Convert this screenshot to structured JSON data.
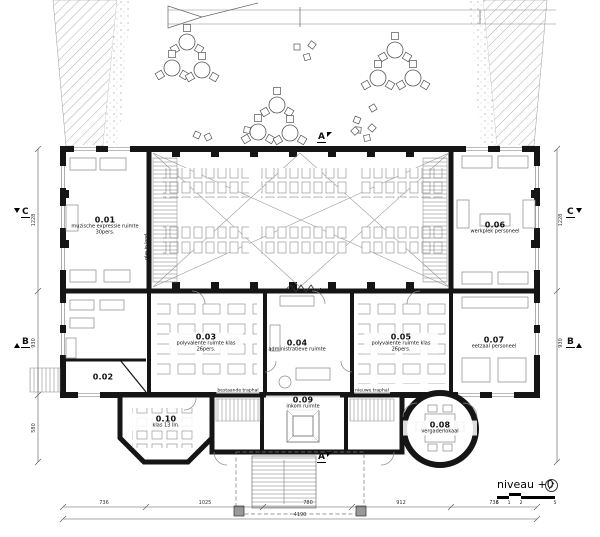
{
  "drawing": {
    "title": "niveau +0",
    "scale_ticks": [
      "0",
      "1",
      "2",
      "5"
    ]
  },
  "icons": {
    "north": "north-arrow-circle",
    "section_cut": "filled-triangle-flag"
  },
  "rooms": [
    {
      "number": "0.01",
      "label": "muzische expressie ruimte 30pers."
    },
    {
      "number": "0.02",
      "label": ""
    },
    {
      "number": "0.03",
      "label": "polyvalente ruimte klas 26pers."
    },
    {
      "number": "0.04",
      "label": "administratieve ruimte"
    },
    {
      "number": "0.05",
      "label": "polyvalente ruimte klas 26pers."
    },
    {
      "number": "0.06",
      "label": "werkplek personeel"
    },
    {
      "number": "0.07",
      "label": "eetzaal personeel"
    },
    {
      "number": "0.08",
      "label": "vergaderlokaal"
    },
    {
      "number": "0.09",
      "label": "inkom ruimte"
    },
    {
      "number": "0.10",
      "label": "klas 13 lln."
    }
  ],
  "annotations": {
    "glas_in_lood": "glas in lood",
    "stair_left": "bestaande traphal",
    "stair_right": "nieuwe traphal"
  },
  "section_markers": {
    "a": "A",
    "b": "B",
    "c": "C"
  },
  "dimensions": {
    "bottom_total": "4190",
    "bottom_segments": [
      "736",
      "1025",
      "780",
      "912",
      "736"
    ],
    "left_segments": [
      "1228",
      "930",
      "580"
    ],
    "right_segments": [
      "1228",
      "930"
    ]
  },
  "courtyard": {
    "tables": [
      [
        187,
        42
      ],
      [
        172,
        68
      ],
      [
        202,
        70
      ],
      [
        277,
        105
      ],
      [
        258,
        132
      ],
      [
        290,
        133
      ],
      [
        395,
        50
      ],
      [
        378,
        78
      ],
      [
        413,
        78
      ]
    ],
    "chairs": [
      [
        297,
        47
      ],
      [
        312,
        45
      ],
      [
        307,
        57
      ],
      [
        357,
        120
      ],
      [
        373,
        108
      ],
      [
        358,
        130
      ],
      [
        372,
        128
      ],
      [
        367,
        138
      ],
      [
        197,
        135
      ],
      [
        208,
        137
      ],
      [
        247,
        130
      ],
      [
        355,
        131
      ]
    ]
  }
}
